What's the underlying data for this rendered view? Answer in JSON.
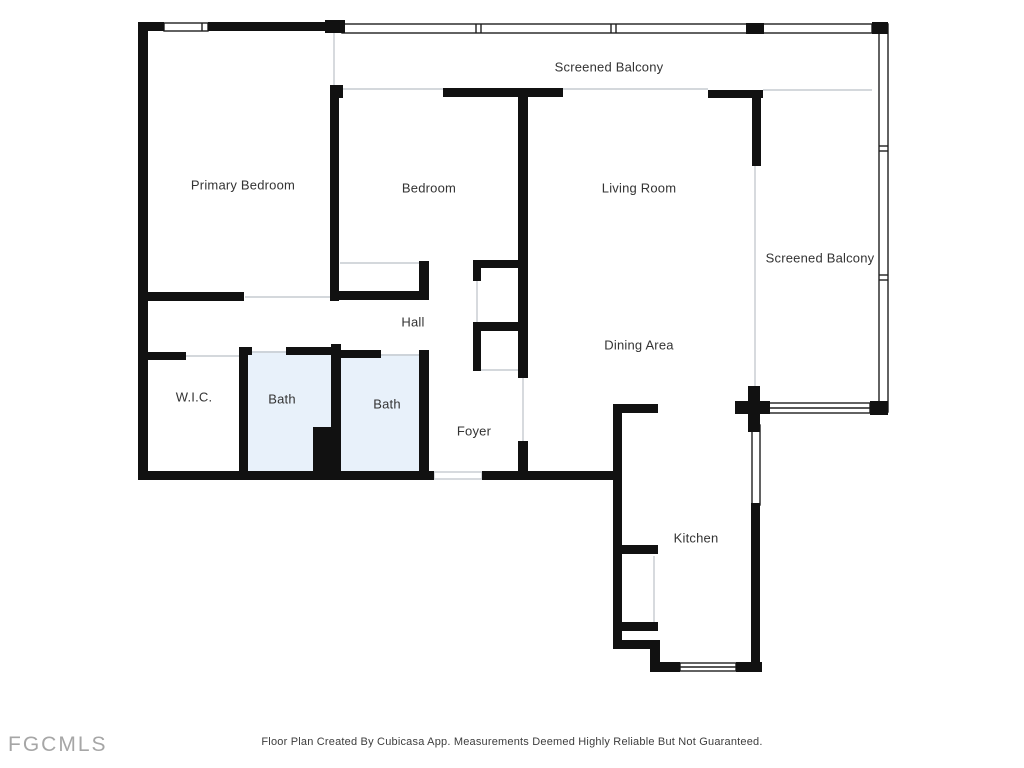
{
  "watermark": "FGCMLS",
  "footer": {
    "disclaimer": "Floor Plan Created By Cubicasa App. Measurements Deemed Highly Reliable But Not Guaranteed."
  },
  "floor_plan": {
    "rooms": {
      "screened_balcony_top": "Screened Balcony",
      "screened_balcony_right": "Screened Balcony",
      "primary_bedroom": "Primary Bedroom",
      "bedroom": "Bedroom",
      "living_room": "Living Room",
      "hall": "Hall",
      "dining_area": "Dining Area",
      "wic": "W.I.C.",
      "bath_left": "Bath",
      "bath_right": "Bath",
      "foyer": "Foyer",
      "kitchen": "Kitchen"
    },
    "colors": {
      "wall": "#111111",
      "bath_fill": "#e8f1fa",
      "thin_line": "#c6cbd0",
      "rail_stroke": "#1f1f1f",
      "label_text": "#333333",
      "watermark_text": "#a6a6a6",
      "disclaimer_text": "#3d3d3d"
    }
  }
}
